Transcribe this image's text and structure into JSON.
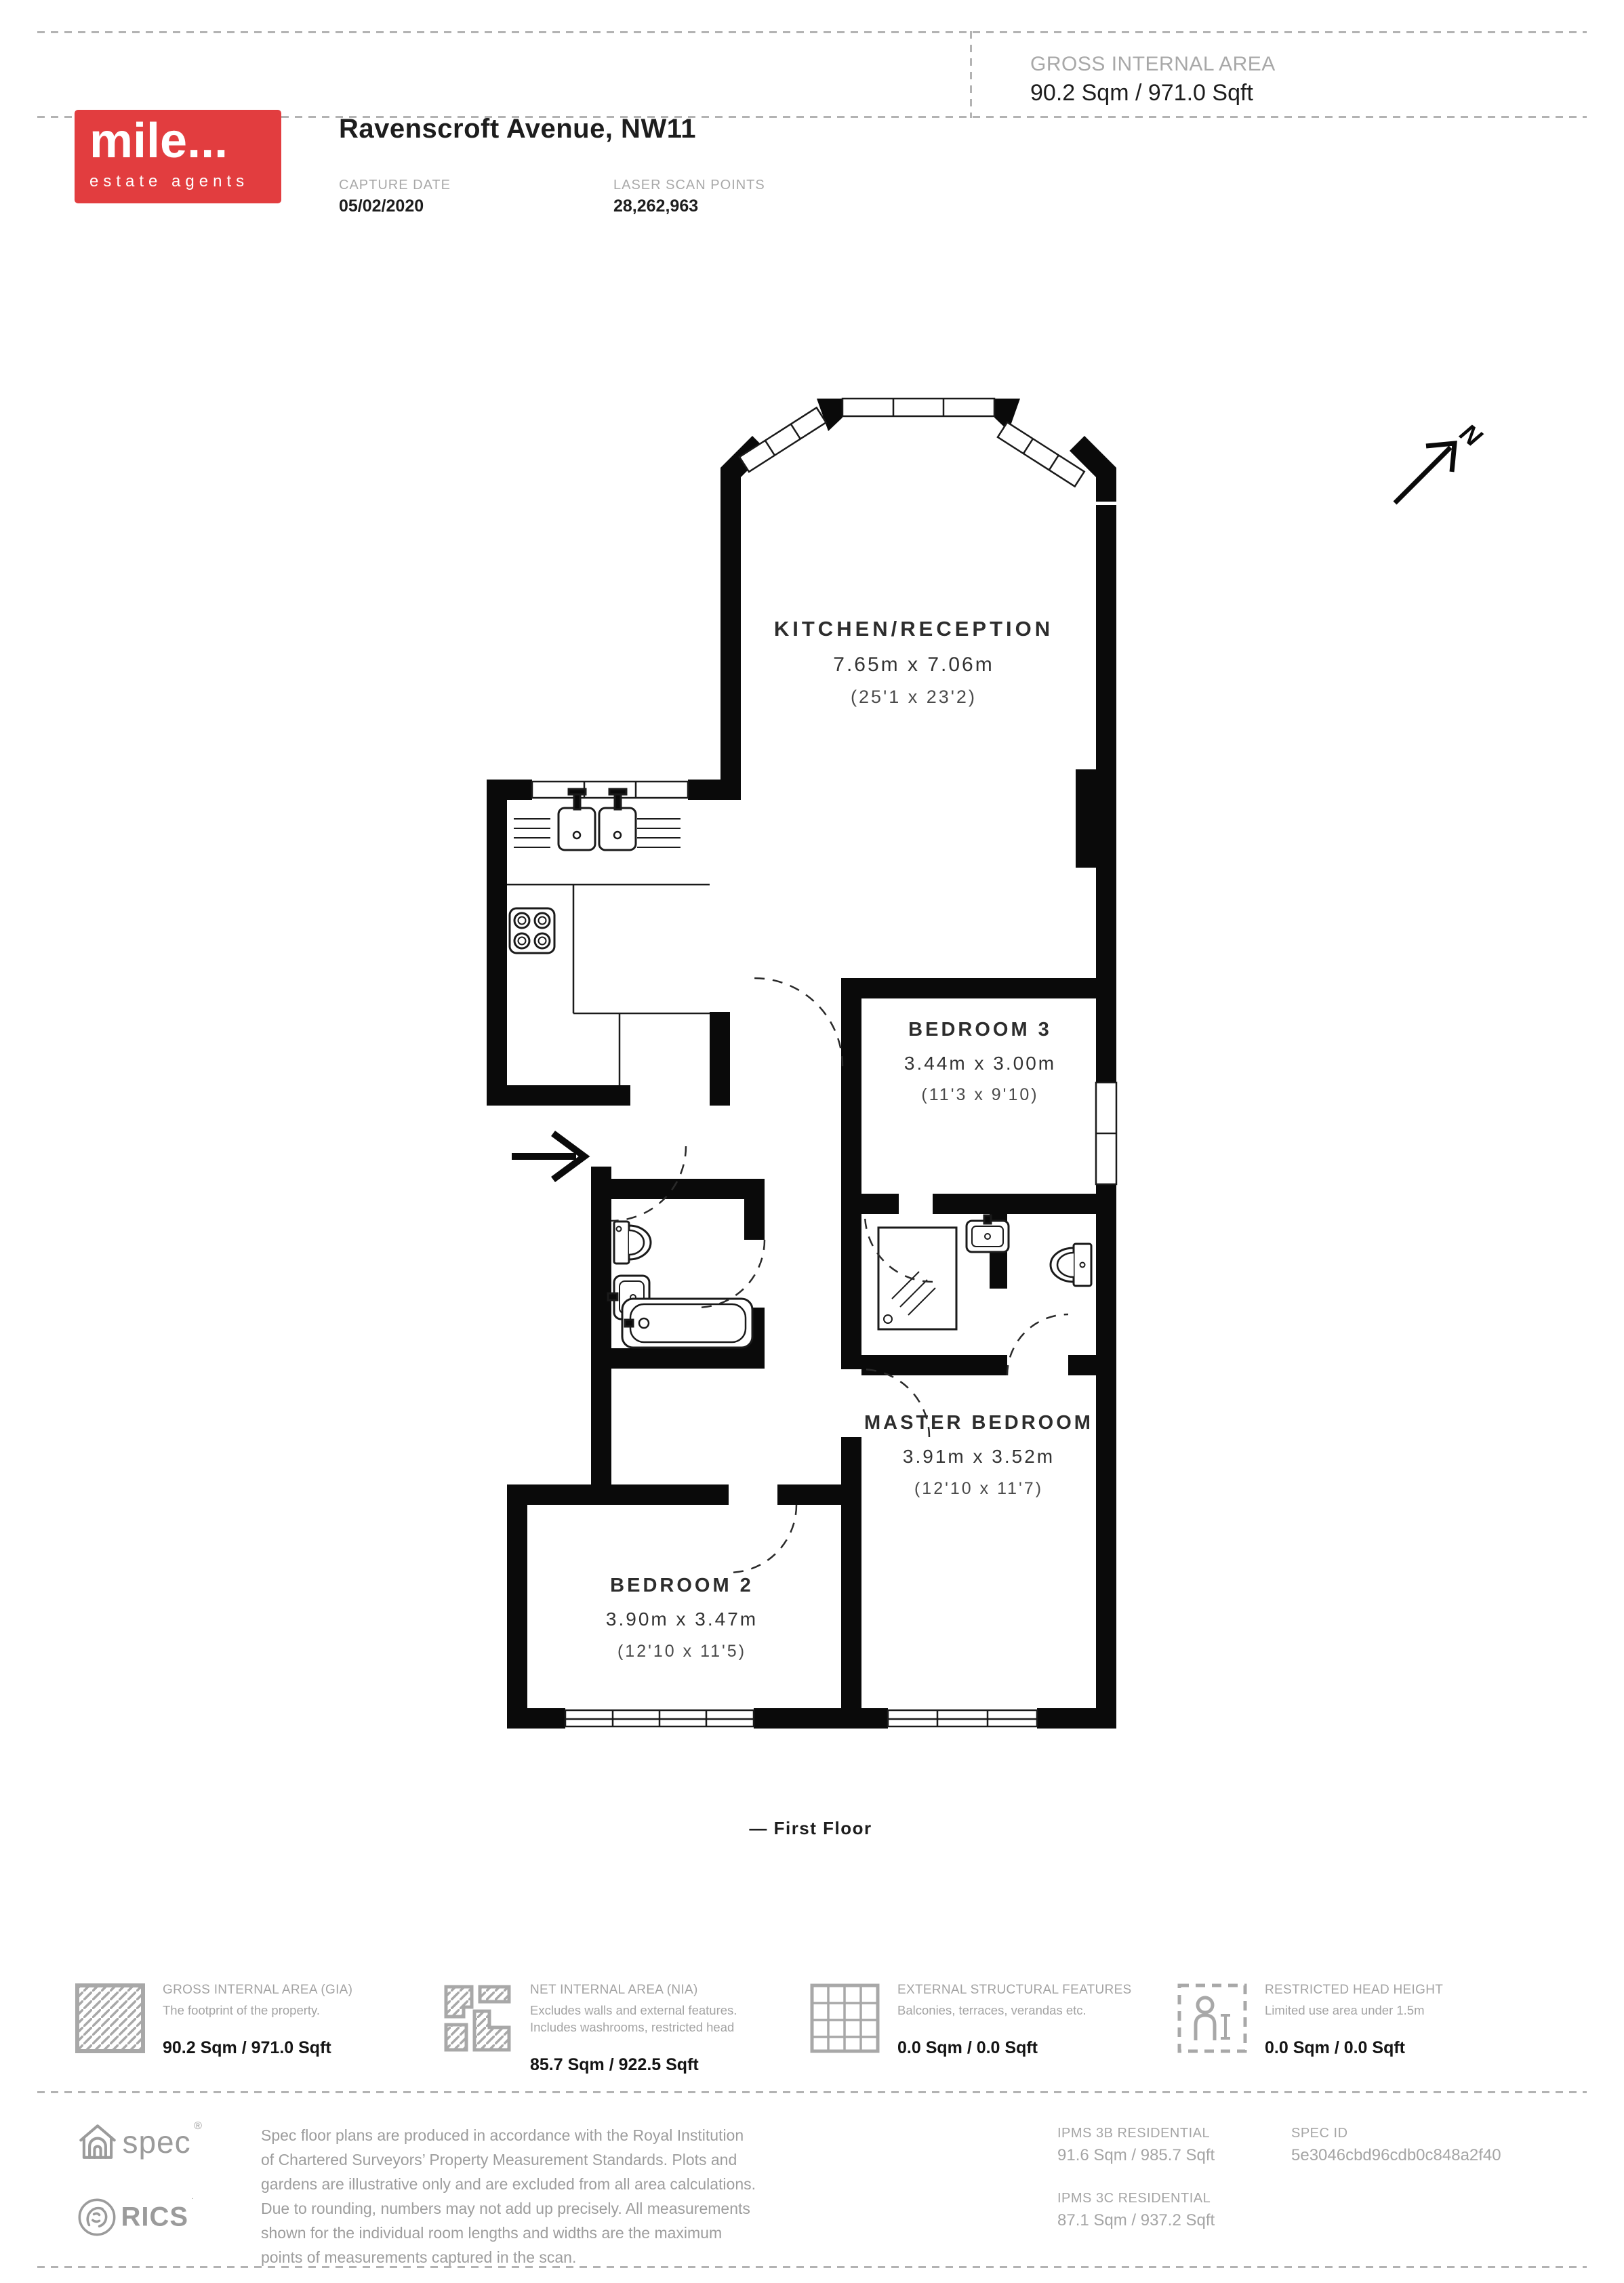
{
  "header": {
    "logo": {
      "brand": "mile...",
      "tagline": "estate agents"
    },
    "title": "Ravenscroft Avenue, NW11",
    "capture_date": {
      "label": "CAPTURE DATE",
      "value": "05/02/2020"
    },
    "laser_scan_points": {
      "label": "LASER SCAN POINTS",
      "value": "28,262,963"
    },
    "gross_internal_area": {
      "label": "GROSS INTERNAL AREA",
      "value": "90.2 Sqm / 971.0 Sqft"
    }
  },
  "plan": {
    "north_label": "N",
    "caption": "— First Floor",
    "rooms": {
      "kitchen": {
        "name": "KITCHEN/RECEPTION",
        "metric": "7.65m x 7.06m",
        "imperial": "(25'1 x 23'2)"
      },
      "bedroom3": {
        "name": "BEDROOM 3",
        "metric": "3.44m x 3.00m",
        "imperial": "(11'3 x 9'10)"
      },
      "bedroom2": {
        "name": "BEDROOM 2",
        "metric": "3.90m x 3.47m",
        "imperial": "(12'10 x 11'5)"
      },
      "master": {
        "name": "MASTER BEDROOM",
        "metric": "3.91m x 3.52m",
        "imperial": "(12'10 x 11'7)"
      }
    }
  },
  "legend": {
    "items": [
      {
        "icon": "hatched-square-icon",
        "title": "GROSS INTERNAL AREA (GIA)",
        "desc": "The footprint of the property.",
        "value": "90.2 Sqm / 971.0 Sqft"
      },
      {
        "icon": "hatched-plan-icon",
        "title": "NET INTERNAL AREA (NIA)",
        "desc": "Excludes walls and external features. Includes washrooms, restricted head",
        "value": "85.7 Sqm / 922.5 Sqft"
      },
      {
        "icon": "grid-icon",
        "title": "EXTERNAL STRUCTURAL FEATURES",
        "desc": "Balconies, terraces, verandas etc.",
        "value": "0.0 Sqm / 0.0 Sqft"
      },
      {
        "icon": "person-height-icon",
        "title": "RESTRICTED HEAD HEIGHT",
        "desc": "Limited use area under 1.5m",
        "value": "0.0 Sqm / 0.0 Sqft"
      }
    ]
  },
  "footer": {
    "spec_logo": "spec",
    "rics_logo": "RICS",
    "disclaimer": "Spec floor plans are produced in accordance with the Royal Institution of Chartered Surveyors’ Property Measurement Standards. Plots and gardens are illustrative only and are excluded from all area calculations. Due to rounding, numbers may not add up precisely. All measurements shown for the individual room lengths and widths are the maximum points of measurements captured in the scan.",
    "ipms_3b": {
      "label": "IPMS 3B RESIDENTIAL",
      "value": "91.6 Sqm / 985.7 Sqft"
    },
    "ipms_3c": {
      "label": "IPMS 3C RESIDENTIAL",
      "value": "87.1 Sqm / 937.2 Sqft"
    },
    "spec_id": {
      "label": "SPEC ID",
      "value": "5e3046cbd96cdb0c848a2f40"
    }
  },
  "colors": {
    "brand_red": "#e23d3f",
    "wall": "#0a0a0a",
    "muted": "#a3a3a3",
    "text": "#1d1d1d",
    "dash": "#b3b3b3"
  }
}
